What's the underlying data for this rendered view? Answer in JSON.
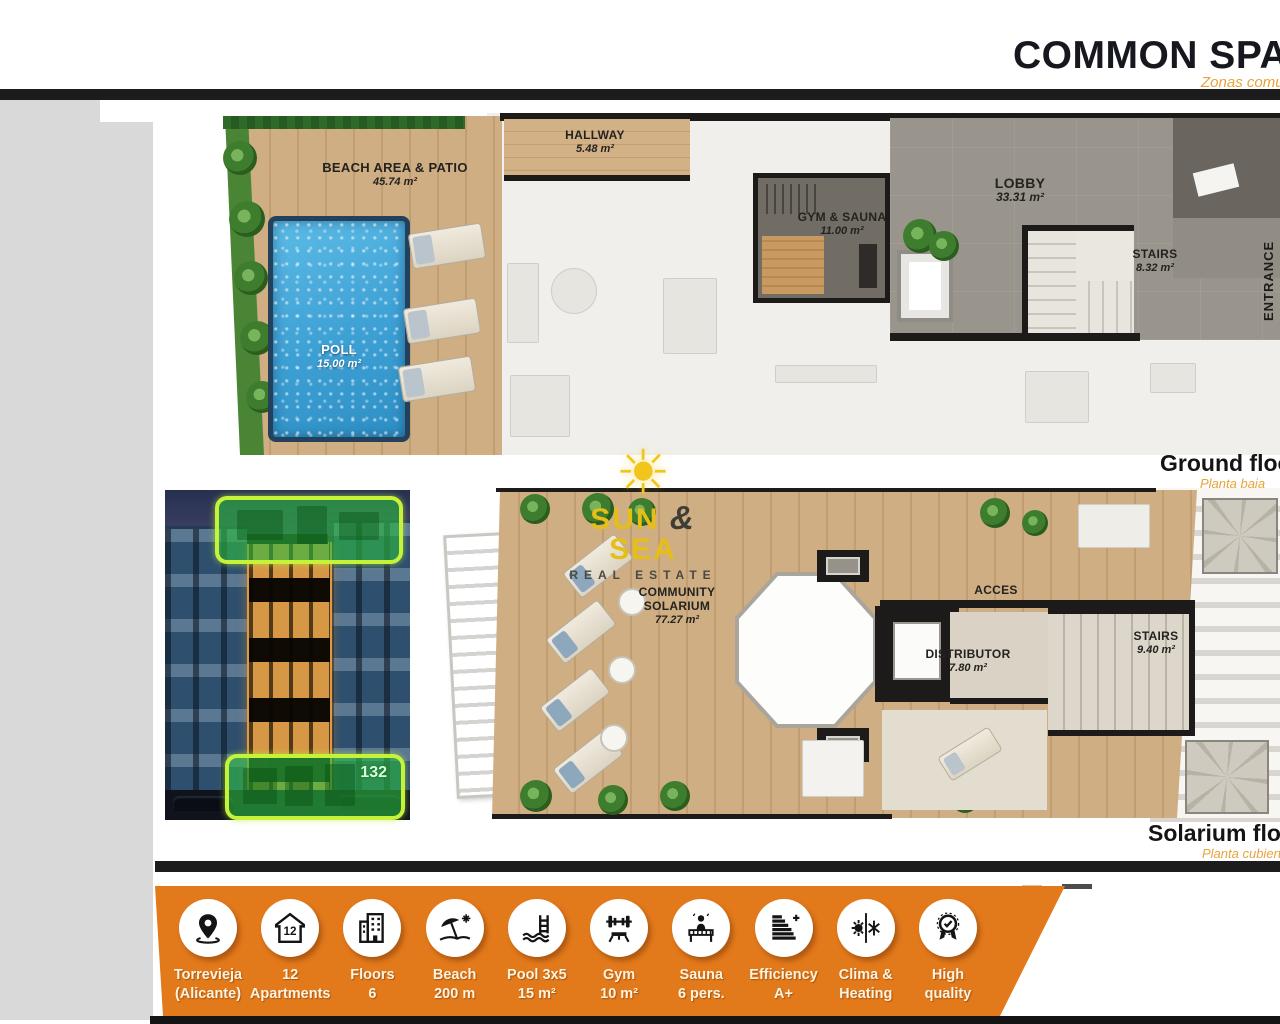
{
  "header": {
    "title": "COMMON SPACES",
    "subtitle": "Zonas comunes"
  },
  "ground_floor": {
    "caption": "Ground floor",
    "caption_es": "Planta baja",
    "rooms": {
      "beach_area": {
        "name": "BEACH AREA & PATIO",
        "area": "45.74 m²"
      },
      "pool": {
        "name": "POLL",
        "area": "15.00 m²"
      },
      "hallway": {
        "name": "HALLWAY",
        "area": "5.48 m²"
      },
      "gym": {
        "name": "GYM & SAUNA",
        "area": "11.00 m²"
      },
      "lobby": {
        "name": "LOBBY",
        "area": "33.31 m²"
      },
      "stairs": {
        "name": "STAIRS",
        "area": "8.32 m²"
      },
      "entrance": {
        "name": "ENTRANCE"
      }
    }
  },
  "solarium_floor": {
    "caption": "Solarium floor",
    "caption_es": "Planta cubierta",
    "rooms": {
      "solarium": {
        "name1": "COMMUNITY",
        "name2": "SOLARIUM",
        "area": "77.27 m²"
      },
      "acces": {
        "name": "ACCES"
      },
      "distributor": {
        "name": "DISTRIBUTOR",
        "area": "7.80 m²"
      },
      "stairs": {
        "name": "STAIRS",
        "area": "9.40 m²"
      }
    }
  },
  "logo": {
    "sun_glyph": "☀",
    "name_left": "SUN",
    "amp": "&",
    "name_right": "SEA",
    "tagline": "REAL ESTATE"
  },
  "photo": {
    "badge": "132"
  },
  "features": [
    {
      "icon": "location-pin",
      "line1": "Torrevieja",
      "line2": "(Alicante)"
    },
    {
      "icon": "house-number",
      "icon_text": "12",
      "line1": "12",
      "line2": "Apartments"
    },
    {
      "icon": "building-floors",
      "line1": "Floors",
      "line2": "6"
    },
    {
      "icon": "beach-umbrella",
      "line1": "Beach",
      "line2": "200 m"
    },
    {
      "icon": "pool-ladder",
      "line1": "Pool 3x5",
      "line2": "15 m²"
    },
    {
      "icon": "gym-weights",
      "line1": "Gym",
      "line2": "10 m²"
    },
    {
      "icon": "sauna-person",
      "line1": "Sauna",
      "line2": "6 pers."
    },
    {
      "icon": "energy-efficiency",
      "line1": "Efficiency",
      "line2": "A+"
    },
    {
      "icon": "clima-heating",
      "line1": "Clima &",
      "line2": "Heating"
    },
    {
      "icon": "high-quality",
      "line1": "High",
      "line2": "quality"
    }
  ],
  "colors": {
    "orange_bar": "#e2791b",
    "accent_orange": "#e8a33d",
    "highlight_green": "#2cba40",
    "highlight_border": "#c6f23a",
    "wood": "#cfae83",
    "pool_blue": "#3da0d4",
    "lobby_gray": "#99958d",
    "wall_black": "#1d1b19"
  }
}
